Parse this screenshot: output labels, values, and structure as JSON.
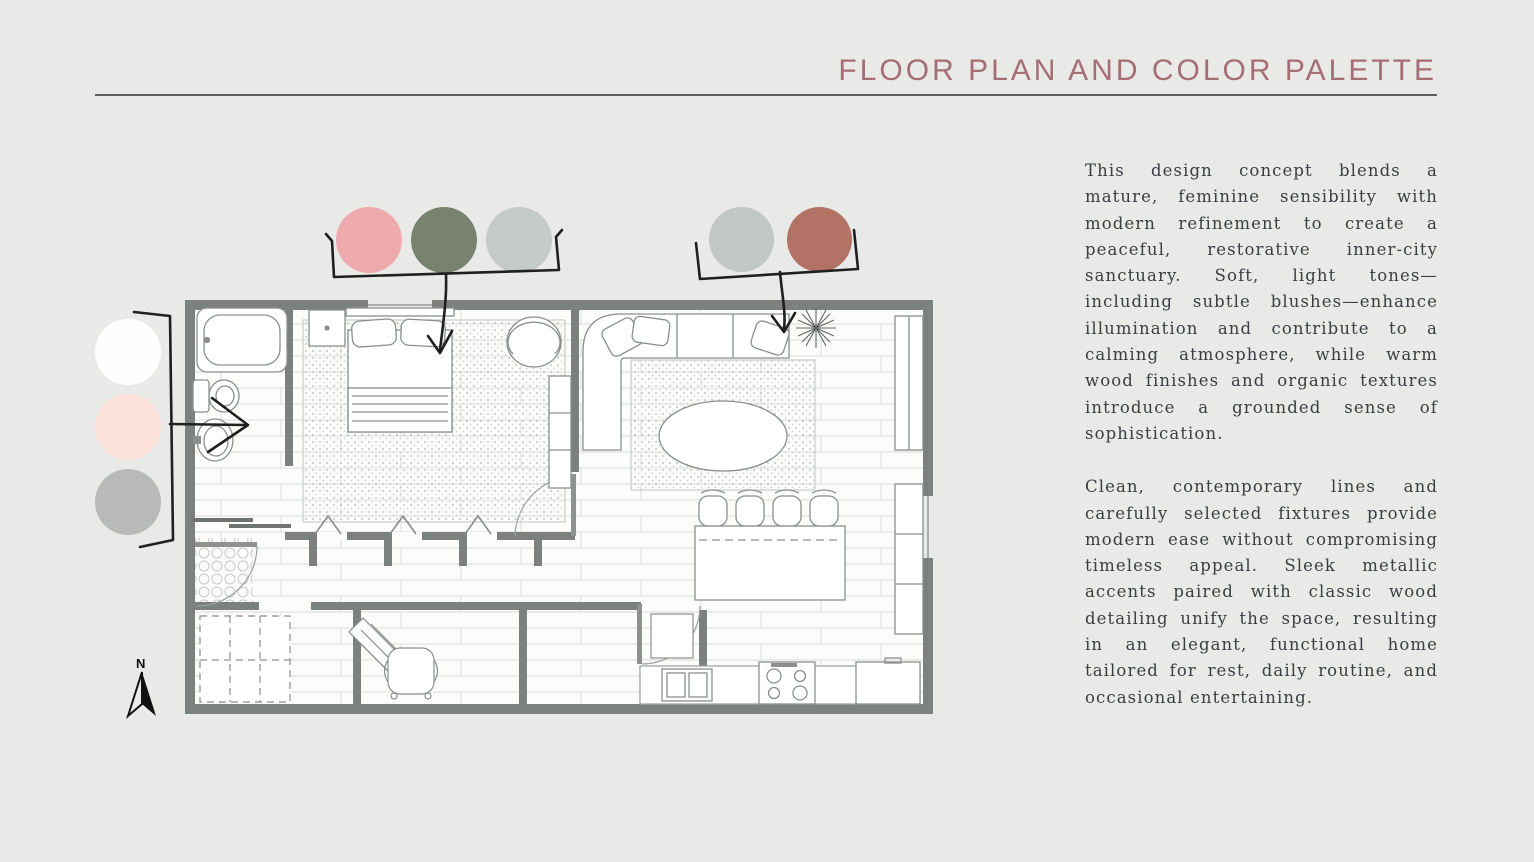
{
  "slide": {
    "title": "FLOOR PLAN AND COLOR PALETTE",
    "paragraphs": {
      "p1": "This design concept blends a mature, feminine sensibility with modern refinement to create a peaceful, restorative inner-city sanctuary. Soft, light tones—including subtle blushes—enhance illumination and contribute to a calming atmosphere, while warm wood finishes and organic textures introduce a grounded sense of sophistication.",
      "p2": "Clean, contemporary lines and carefully selected fixtures provide modern ease without compromising timeless appeal. Sleek metallic accents paired with classic wood detailing unify the space, resulting in an elegant, functional home tailored for rest, daily routine, and occasional entertaining."
    }
  },
  "palette": {
    "bedroom_group": {
      "swatches": [
        {
          "name": "blush-pink",
          "color": "#eeaaad"
        },
        {
          "name": "sage-green",
          "color": "#78826e"
        },
        {
          "name": "light-gray",
          "color": "#c5cac7"
        }
      ]
    },
    "living_group": {
      "swatches": [
        {
          "name": "light-gray",
          "color": "#c2c7c4"
        },
        {
          "name": "terracotta",
          "color": "#b27265"
        }
      ]
    },
    "bathroom_group": {
      "swatches": [
        {
          "name": "white",
          "color": "#fefefe"
        },
        {
          "name": "pale-blush",
          "color": "#fee3dd"
        },
        {
          "name": "mid-gray",
          "color": "#b7bab9"
        }
      ]
    }
  },
  "compass": {
    "label": "N"
  },
  "colors": {
    "background": "#e9e9e7",
    "title": "#a56e75",
    "rule": "#5d5d5d",
    "body_text": "#3a3e41",
    "wall": "#7c807e",
    "annotation_ink": "#1f1f1f"
  }
}
